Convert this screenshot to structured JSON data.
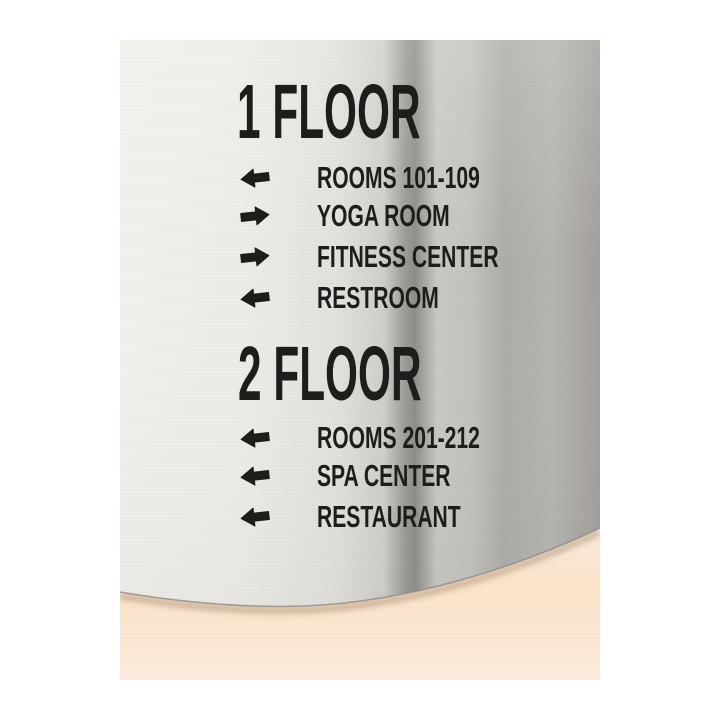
{
  "colors": {
    "page_bg": "#ffffff",
    "ink": "#1e1d1b",
    "metal_light": "#f1f0ec",
    "metal_mid": "#c9c7c3",
    "metal_dark": "#8f8d89",
    "wall_top": "#f8ecdd",
    "wall_mid": "#fce3cb",
    "wall_bottom": "#fdeede"
  },
  "icons": {
    "left_arrow": "⬅",
    "right_arrow": "➡"
  },
  "sign": {
    "sections": [
      {
        "heading": "1 FLOOR",
        "rows": [
          {
            "direction": "left",
            "label": "ROOMS 101-109"
          },
          {
            "direction": "right",
            "label": "YOGA ROOM"
          },
          {
            "direction": "right",
            "label": "FITNESS CENTER"
          },
          {
            "direction": "left",
            "label": "RESTROOM"
          }
        ]
      },
      {
        "heading": "2 FLOOR",
        "rows": [
          {
            "direction": "left",
            "label": "ROOMS 201-212"
          },
          {
            "direction": "left",
            "label": "SPA CENTER"
          },
          {
            "direction": "left",
            "label": "RESTAURANT"
          }
        ]
      }
    ]
  }
}
